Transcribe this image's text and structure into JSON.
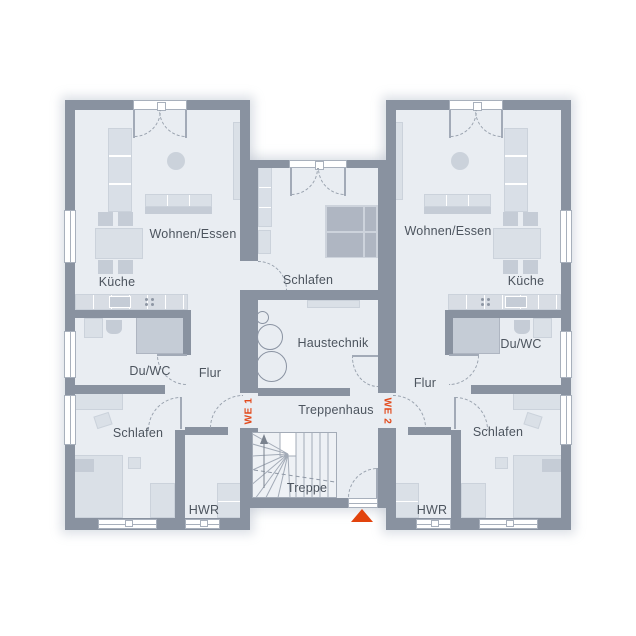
{
  "floor_plan": {
    "unit1": {
      "id": "WE 1",
      "rooms": {
        "wohnen_essen": "Wohnen/Essen",
        "kueche": "Küche",
        "du_wc": "Du/WC",
        "flur": "Flur",
        "schlafen": "Schlafen",
        "hwr": "HWR"
      }
    },
    "unit2": {
      "id": "WE 2",
      "rooms": {
        "wohnen_essen": "Wohnen/Essen",
        "kueche": "Küche",
        "du_wc": "Du/WC",
        "flur": "Flur",
        "schlafen": "Schlafen",
        "hwr": "HWR"
      }
    },
    "common": {
      "schlafen": "Schlafen",
      "haustechnik": "Haustechnik",
      "treppenhaus": "Treppenhaus",
      "treppe": "Treppe"
    },
    "colors": {
      "wall": "#8992A0",
      "floor": "#E9EDF2",
      "accent": "#E2491B",
      "furniture": "#DAE0E7",
      "text": "#4C545E"
    }
  }
}
